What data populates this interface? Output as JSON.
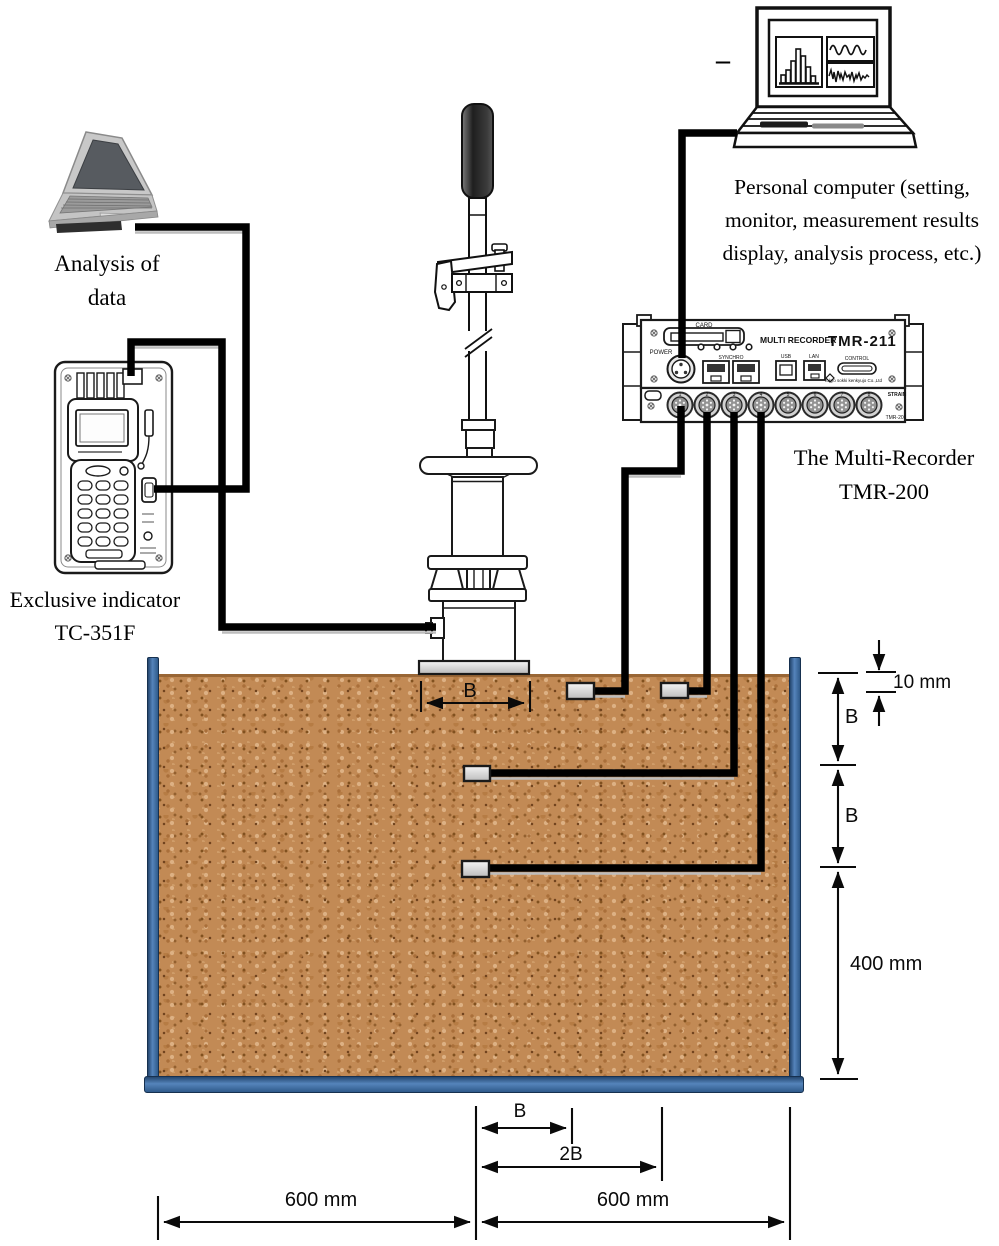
{
  "captions": {
    "analysis": [
      "Analysis of",
      "data"
    ],
    "personal_computer": [
      "Personal computer (setting,",
      "monitor, measurement results",
      "display, analysis process, etc.)"
    ],
    "indicator": [
      "Exclusive indicator",
      "TC-351F"
    ],
    "recorder": [
      "The Multi-Recorder",
      "TMR-200"
    ],
    "dash": "–"
  },
  "recorder_panel": {
    "brand": "MULTI RECORDER",
    "model": "TMR-211",
    "card": "CARD",
    "power": "POWER",
    "synchro": "SYNCHRO",
    "usb": "USB",
    "lan": "LAN",
    "control": "CONTROL",
    "maker": "Tokyo sokki kenkyujo Co.,Ltd",
    "strain": "STRAIN",
    "model_small": "TMR-201",
    "channels": [
      "1",
      "2",
      "3",
      "4",
      "5",
      "6",
      "7",
      "8"
    ]
  },
  "dimensions": {
    "footing_width": "B",
    "depth_first": "B",
    "depth_second": "B",
    "embedment": "10 mm",
    "box_depth": "400 mm",
    "offset_b": "B",
    "offset_2b": "2B",
    "left_width": "600 mm",
    "right_width": "600 mm"
  },
  "colors": {
    "sand": "#c28a55",
    "box_wall": "#3f6ea5",
    "cable": "#000000",
    "plate": "#d9d9d9"
  }
}
